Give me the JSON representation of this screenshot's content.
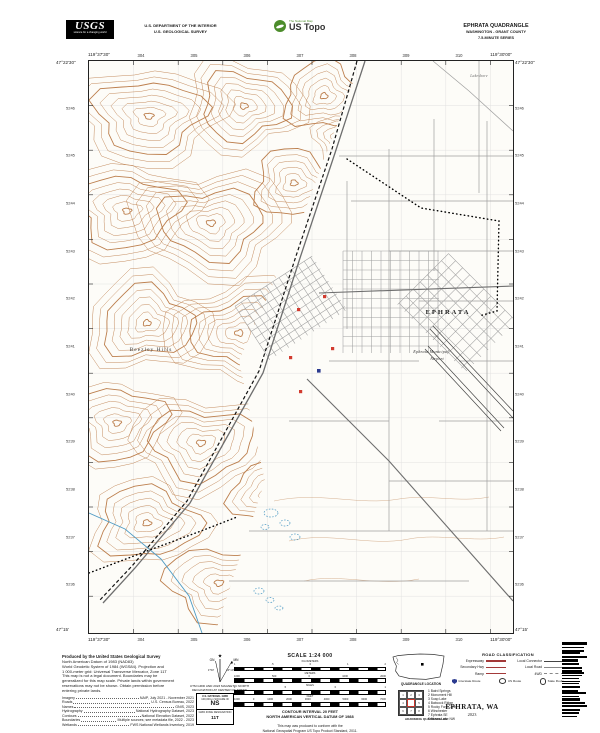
{
  "header": {
    "logo": {
      "name": "USGS",
      "tagline": "science for a changing world"
    },
    "department": {
      "line1": "U.S. DEPARTMENT OF THE INTERIOR",
      "line2": "U.S. GEOLOGICAL SURVEY"
    },
    "ustopo": {
      "program": "The National Map",
      "brand": "US Topo"
    },
    "quad": {
      "title": "EPHRATA QUADRANGLE",
      "region": "WASHINGTON - GRANT COUNTY",
      "series": "7.5-MINUTE SERIES"
    }
  },
  "map": {
    "corners": {
      "top_left_lat": "47°22'30\"",
      "top_left_lon": "119°37'30\"",
      "top_right_lat": "47°22'30\"",
      "top_right_lon": "119°30'00\"",
      "bottom_left_lat": "47°15'",
      "bottom_left_lon": "119°37'30\"",
      "bottom_right_lat": "47°15'",
      "bottom_right_lon": "119°30'00\""
    },
    "top_ticks": [
      "304",
      "305",
      "306",
      "307",
      "308",
      "309",
      "310"
    ],
    "bottom_ticks": [
      "304",
      "305",
      "306",
      "307",
      "308",
      "309",
      "310"
    ],
    "left_ticks": [
      "5246",
      "5245",
      "5244",
      "5243",
      "5242",
      "5241",
      "5240",
      "5239",
      "5238",
      "5237",
      "5236"
    ],
    "right_ticks": [
      "5246",
      "5245",
      "5244",
      "5243",
      "5242",
      "5241",
      "5240",
      "5239",
      "5238",
      "5237",
      "5236"
    ],
    "labels": [
      {
        "text": "EPHRATA",
        "x": 359,
        "y": 253,
        "cls": "city"
      },
      {
        "text": "Beezley Hills",
        "x": 62,
        "y": 290,
        "cls": "terrain"
      },
      {
        "text": "Ephrata Municipal",
        "x": 342,
        "y": 292,
        "cls": "airport"
      },
      {
        "text": "Airport",
        "x": 348,
        "y": 299,
        "cls": "airport"
      },
      {
        "text": "Lakeshore",
        "x": 390,
        "y": 16,
        "cls": "minor"
      }
    ]
  },
  "footer": {
    "produced": "Produced by the United States Geological Survey",
    "datum_lines": [
      "North American Datum of 1983 (NAD83)",
      "World Geodetic System of 1984 (WGS84). Projection and",
      "1 000-meter grid: Universal Transverse Mercator, Zone 11T",
      "This map is not a legal document. Boundaries may be",
      "generalized for this map scale. Private lands within government",
      "reservations may not be shown. Obtain permission before",
      "entering private lands."
    ],
    "sources": [
      {
        "label": "Imagery",
        "value": "NAIP, July 2021 - November 2021"
      },
      {
        "label": "Roads",
        "value": "U.S. Census Bureau, 2022"
      },
      {
        "label": "Names",
        "value": "GNIS, 2023"
      },
      {
        "label": "Hydrography",
        "value": "National Hydrography Dataset, 2023"
      },
      {
        "label": "Contours",
        "value": "National Elevation Dataset, 2022"
      },
      {
        "label": "Boundaries",
        "value": "Multiple sources; see metadata file, 2022 - 2023"
      },
      {
        "label": "Wetlands",
        "value": "FWS National Wetlands Inventory, 2019"
      }
    ],
    "declination": {
      "caption_line1": "UTM GRID AND 2023 MAGNETIC NORTH",
      "caption_line2": "DECLINATION AT CENTER OF SHEET",
      "star": "★",
      "gn_label": "GN",
      "mn_label": "MN",
      "gn_value": "1°53'",
      "mn_value": "14°10'"
    },
    "usng": {
      "title": "U.S. NATIONAL GRID",
      "square_label": "100,000-m SQUARE ID",
      "square_id": "NS",
      "zone_label": "GRID ZONE DESIGNATION",
      "zone": "11T"
    },
    "scale": {
      "title": "SCALE 1:24 000",
      "rows": [
        {
          "unit": "KILOMETERS",
          "labels": [
            "1",
            ".5",
            "0",
            "1",
            "2"
          ]
        },
        {
          "unit": "METERS",
          "labels": [
            "1000",
            "500",
            "0",
            "1000",
            "2000"
          ]
        },
        {
          "unit": "MILES",
          "labels": [
            "1",
            ".5",
            "0",
            "1"
          ]
        },
        {
          "unit": "FEET",
          "labels": [
            "1000",
            "0",
            "1000",
            "2000",
            "3000",
            "4000",
            "5000",
            "6000",
            "7000"
          ]
        }
      ],
      "contour_line1": "CONTOUR INTERVAL 20 FEET",
      "contour_line2": "NORTH AMERICAN VERTICAL DATUM OF 1988",
      "standard_line1": "This map was produced to conform with the",
      "standard_line2": "National Geospatial Program US Topo Product Standard, 2011."
    },
    "location": {
      "caption": "QUADRANGLE LOCATION"
    },
    "adjoining": {
      "caption": "ADJOINING QUADRANGLES",
      "quads": [
        "Baird Springs",
        "Monument Hill",
        "Soap Lake",
        "Babcock Ridge",
        "Rocky Ford Creek",
        "Winchester",
        "Ephrata SE",
        "Moses Lake NW"
      ]
    },
    "roadclass": {
      "title": "ROAD CLASSIFICATION",
      "pairs": [
        [
          {
            "label": "Expressway",
            "style": "expressway"
          },
          {
            "label": "Local Connector",
            "style": "connector"
          }
        ],
        [
          {
            "label": "Secondary Hwy",
            "style": "secondary"
          },
          {
            "label": "Local Road",
            "style": "local"
          }
        ],
        [
          {
            "label": "Ramp",
            "style": "ramp"
          },
          {
            "label": "4WD",
            "style": "fourwd"
          }
        ]
      ],
      "shields": [
        {
          "type": "interstate",
          "label": "Interstate Route"
        },
        {
          "type": "us",
          "label": "US Route"
        },
        {
          "type": "state",
          "label": "State Route"
        }
      ]
    },
    "sheet": {
      "name": "EPHRATA, WA",
      "year": "2023"
    }
  },
  "colors": {
    "contour": "#b5713a",
    "water": "#4f9bc4",
    "road": "#9f9f9f",
    "main_road": "#6e6e6e",
    "building_red": "#d23b2f",
    "building_blue": "#2b3a8f",
    "legend_red": "#a33a3a",
    "brand_green": "#4c8c2b"
  }
}
